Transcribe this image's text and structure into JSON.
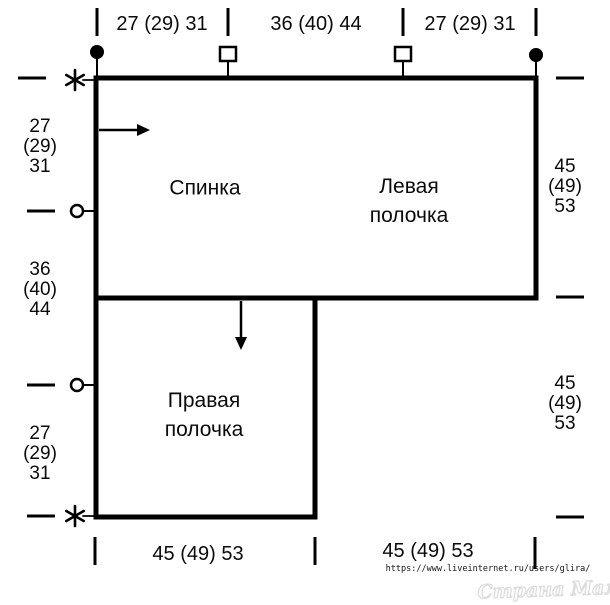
{
  "pieces": {
    "back": "Спинка",
    "left_front": "Левая\nполочка",
    "right_front": "Правая\nполочка"
  },
  "dims": {
    "top": [
      "27 (29) 31",
      "36 (40) 44",
      "27 (29) 31"
    ],
    "left": [
      "27\n(29)\n31",
      "36\n(40)\n44",
      "27\n(29)\n31"
    ],
    "right": [
      "45\n(49)\n53",
      "45\n(49)\n53"
    ],
    "bottom": [
      "45 (49) 53",
      "45 (49) 53"
    ]
  },
  "credit": {
    "url": "https://www.liveinternet.ru/users/glira/",
    "watermark": "Страна Мам"
  },
  "colors": {
    "line": "#000000",
    "background": "#ffffff",
    "watermark_stroke": "#dcdcdc"
  }
}
